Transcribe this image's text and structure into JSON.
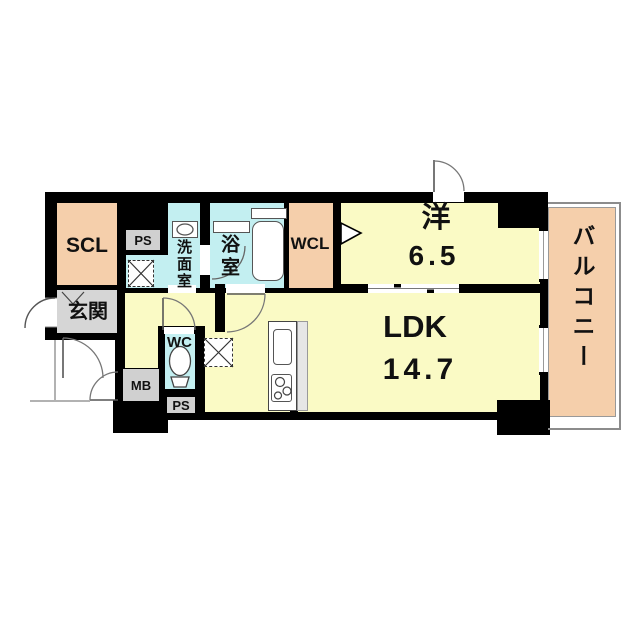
{
  "title": "apartment-floor-plan",
  "colors": {
    "wall": "#000000",
    "room_yellow": "#FAFAC5",
    "service_cyan": "#C3EFF1",
    "closet_peach": "#F5CFAB",
    "entry_gray": "#D6D6D6",
    "box_gray": "#D0D0D0",
    "line_gray": "#8C8C8C"
  },
  "rooms": {
    "scl": {
      "label": "SCL"
    },
    "ps_upper": {
      "label": "PS"
    },
    "washroom": {
      "label": "洗面室"
    },
    "bathroom": {
      "label": "浴室"
    },
    "wcl": {
      "label": "WCL"
    },
    "western_room": {
      "label": "洋",
      "size": "6.5"
    },
    "balcony": {
      "label": "バルコニー"
    },
    "genkan": {
      "label": "玄関"
    },
    "wc": {
      "label": "WC"
    },
    "mb": {
      "label": "MB"
    },
    "ps_lower": {
      "label": "PS"
    },
    "ldk": {
      "label": "LDK",
      "size": "14.7"
    }
  }
}
